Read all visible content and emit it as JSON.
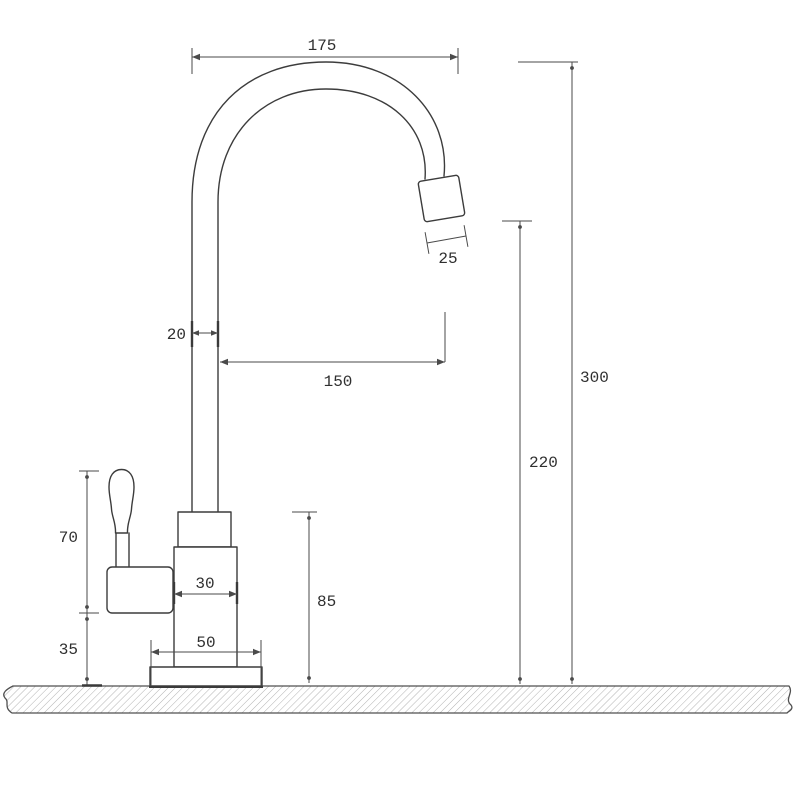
{
  "drawing": {
    "title": "Single-lever drinking water faucet dimensional drawing",
    "view": "side elevation",
    "dimensions": {
      "spout_reach": "175",
      "spout_tip_width": "25",
      "pipe_diameter": "20",
      "spout_projection": "150",
      "overall_height": "300",
      "outlet_height": "220",
      "body_height": "85",
      "handle_height": "70",
      "base_clearance": "35",
      "body_width": "30",
      "base_width": "50"
    },
    "colors": {
      "outline": "#3c3c3c",
      "dimension_line": "#4a4a4a",
      "label_text": "#2f2f2f",
      "hatch": "#b3b3b3",
      "background": "#ffffff"
    }
  }
}
